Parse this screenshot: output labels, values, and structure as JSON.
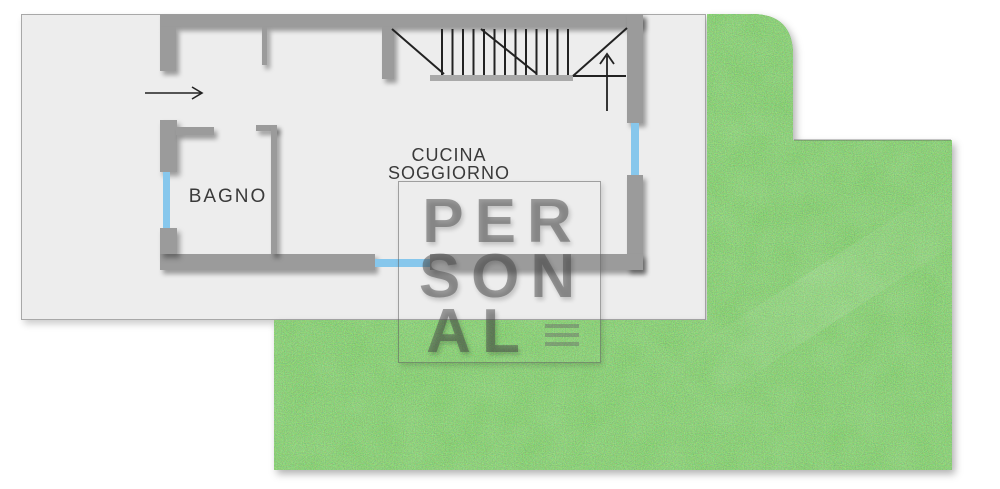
{
  "rooms": {
    "bagno": {
      "label": "BAGNO"
    },
    "cucina_soggiorno": {
      "line1": "CUCINA",
      "line2": "SOGGIORNO"
    }
  },
  "watermark": {
    "line1": "PER",
    "line2": "SON",
    "line3": "AL"
  },
  "icons": {
    "entrance_arrow": "right-arrow",
    "stairs_up_arrow": "up-arrow"
  },
  "colors": {
    "wall": "#9b9b9b",
    "window_blue": "#87c7ec",
    "slab": "#ededed",
    "slab_border": "#a8a8a8",
    "grass_green": "#4a9e35",
    "line_dark": "#222222",
    "label_text": "#3a3a3a",
    "watermark_gray": "rgba(72,72,72,0.5)"
  }
}
